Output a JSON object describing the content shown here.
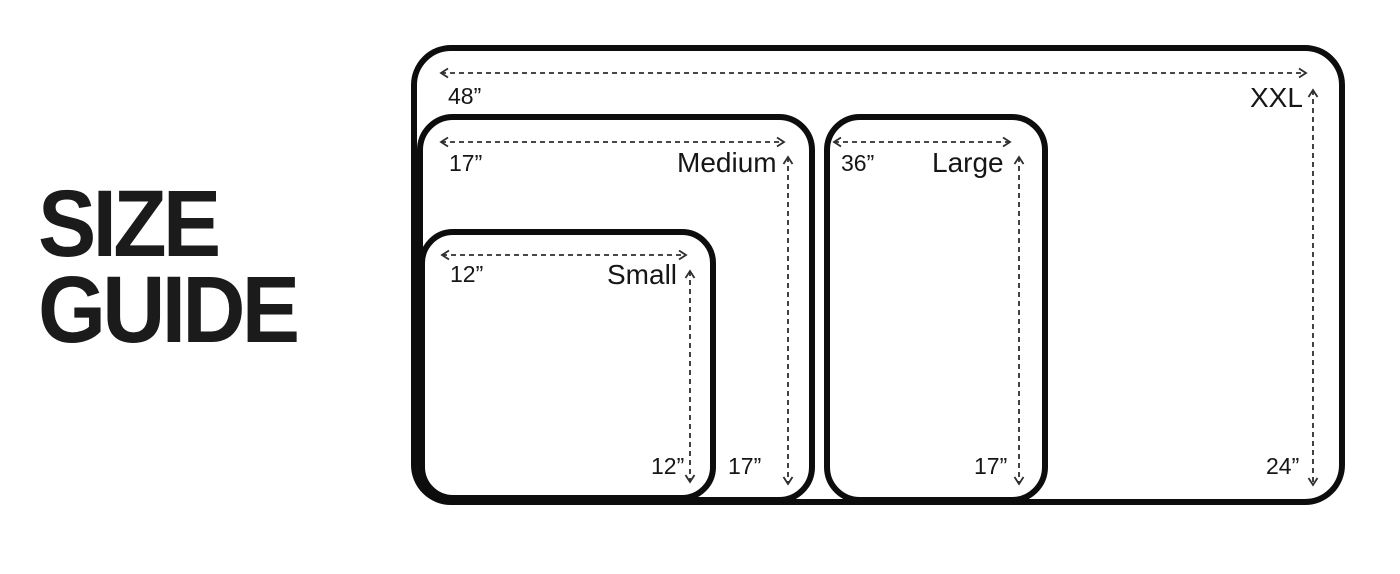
{
  "title": {
    "line1": "SIZE",
    "line2": "GUIDE"
  },
  "sizes": [
    {
      "name": "Small",
      "width_label": "12”",
      "height_label": "12”"
    },
    {
      "name": "Medium",
      "width_label": "17”",
      "height_label": "17”"
    },
    {
      "name": "Large",
      "width_label": "36”",
      "height_label": "17”"
    },
    {
      "name": "XXL",
      "width_label": "48”",
      "height_label": "24”"
    }
  ],
  "colors": {
    "background": "#ffffff",
    "outline": "#0d0d0d",
    "arrow": "#2e2e2e",
    "text": "#161616",
    "title_text": "#1b1b1b"
  }
}
